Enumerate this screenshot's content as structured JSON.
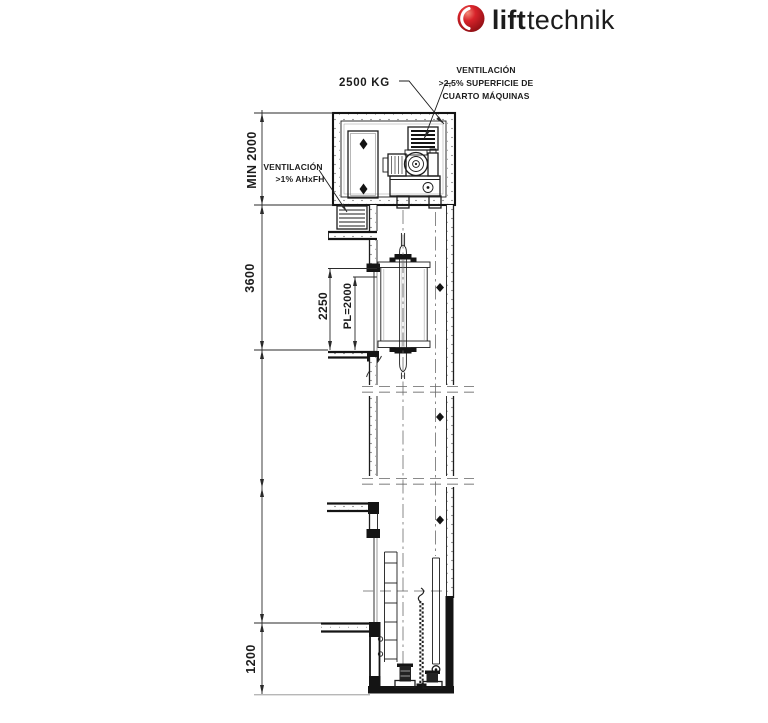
{
  "logo": {
    "lift": "lift",
    "technik": "technik"
  },
  "annotations": {
    "load": "2500 KG",
    "vent_machine_room": [
      "VENTILACIÓN",
      ">2,5% SUPERFICIE DE",
      "CUARTO MÁQUINAS"
    ],
    "vent_shaft": [
      "VENTILACIÓN",
      ">1% AHxFH"
    ]
  },
  "dimensions": {
    "machine_room_height": "MIN 2000",
    "top_floor_to_machine_room": "3600",
    "door_structural_height": "2250",
    "door_clear_height": "PL=2000",
    "pit_depth": "1200"
  },
  "colors": {
    "brand_red": "#c9161c",
    "logo_dark": "#645d57",
    "logo_light": "#a5a19c",
    "line": "#1c1c1c"
  }
}
